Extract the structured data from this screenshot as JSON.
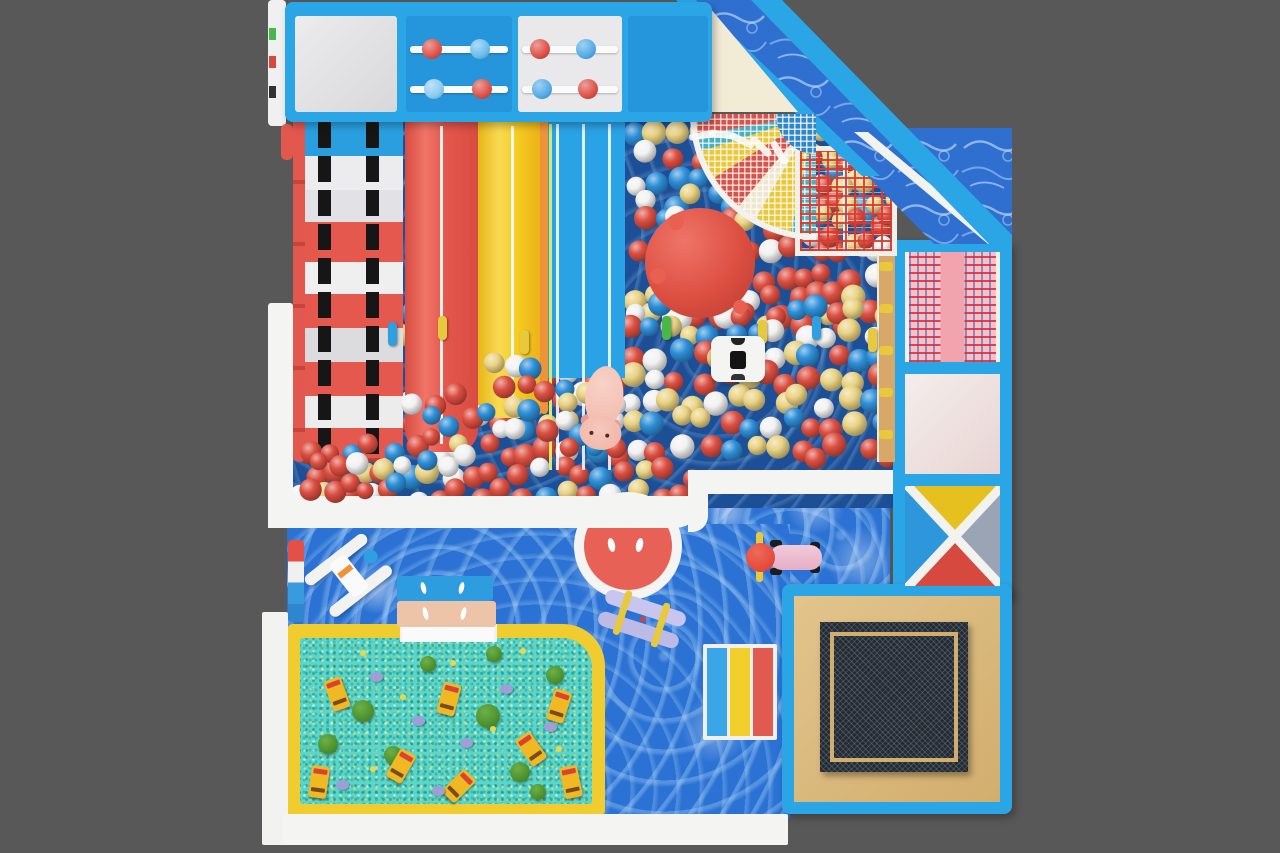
{
  "scene": {
    "name": "indoor-playground-top-view",
    "width": 1280,
    "height": 853,
    "background": "#585858"
  },
  "palette": {
    "bg": "#585858",
    "frame-blue": "#2aa6e6",
    "frame-blue-dark": "#1b86cc",
    "water-base": "#2b72d4",
    "pit-floor": "#1d4f96",
    "panel-gray": "#e2e2e4",
    "panel-white": "#eaeaec",
    "panel-blue": "#2596dc",
    "cream": "#f2ecd6",
    "slide-red": "#e4574c",
    "slide-red-light": "#f07568",
    "slide-yellow": "#f5c91e",
    "slide-orange": "#ef9338",
    "lane-blue": "#2aa2e6",
    "ladder-red": "#e2574e",
    "strap-black": "#161616",
    "white": "#f2f2f2",
    "meadow": "#5cd6c8",
    "meadow-border": "#f0cc2e",
    "tan": "#d9b87c",
    "tan-frame": "#d2ae6e",
    "wood": "#d8a868",
    "mesh-dark": "#232a32",
    "pink-panel": "#f4c2c8",
    "pink-stripe": "#f2a4ae",
    "x-yellow": "#e6c01e",
    "x-blue": "#2e96da",
    "x-gray": "#9aa4b4",
    "x-red": "#d6493e",
    "big-red-ball": "#dc4f41",
    "big-yellow-ball": "#ecc92c",
    "circle-red": "#e86156",
    "pig-pink": "#f4bfb2",
    "scooter-pink": "#eebcd0",
    "boat-lavender": "#c8c6ee",
    "bench-blue": "#2d9de0",
    "bench-tan": "#edc4a8",
    "peg-yellow": "#e8c83c",
    "peg-blue": "#2e9fe0",
    "peg-green": "#49b84a",
    "bus-yellow": "#f0b822",
    "bus-red": "#d84434",
    "tree-green": "#4a8f2a",
    "rock-lavender": "#9f9fd8",
    "flower-yellow": "#e8d84a",
    "mat-blue": "#3aa6e8",
    "mat-yellow": "#f2cf2a",
    "mat-red": "#e05a50"
  },
  "balls": {
    "colors": {
      "red": "#dc4f41",
      "blue": "#2e8fd8",
      "white": "#f2f2f2",
      "yellow": "#ead383"
    },
    "seed": 13,
    "regions": [
      {
        "name": "pit-top-right",
        "x": 628,
        "y": 124,
        "w": 262,
        "h": 118,
        "sp": 22,
        "r": 11,
        "layer": "low",
        "weights": {
          "blue": 0.3,
          "white": 0.2,
          "yellow": 0.2,
          "red": 0.3
        }
      },
      {
        "name": "pit-red-band",
        "x": 628,
        "y": 242,
        "w": 262,
        "h": 92,
        "sp": 22,
        "r": 11,
        "layer": "low",
        "weights": {
          "red": 0.55,
          "yellow": 0.18,
          "white": 0.15,
          "blue": 0.12
        }
      },
      {
        "name": "pit-mid-mix",
        "x": 296,
        "y": 300,
        "w": 592,
        "h": 68,
        "sp": 22,
        "r": 11,
        "layer": "low",
        "weights": {
          "blue": 0.33,
          "white": 0.25,
          "yellow": 0.17,
          "red": 0.25
        }
      },
      {
        "name": "pit-lower-mix",
        "x": 296,
        "y": 368,
        "w": 592,
        "h": 72,
        "sp": 22,
        "r": 11,
        "layer": "low",
        "weights": {
          "red": 0.38,
          "blue": 0.2,
          "white": 0.18,
          "yellow": 0.24
        }
      },
      {
        "name": "pit-bottom-red",
        "x": 296,
        "y": 440,
        "w": 400,
        "h": 62,
        "sp": 22,
        "r": 11,
        "layer": "low",
        "weights": {
          "red": 0.58,
          "white": 0.16,
          "yellow": 0.16,
          "blue": 0.1
        }
      },
      {
        "name": "pit-bottom-right",
        "x": 698,
        "y": 440,
        "w": 192,
        "h": 30,
        "sp": 22,
        "r": 11,
        "layer": "low",
        "weights": {
          "red": 0.5,
          "blue": 0.2,
          "white": 0.15,
          "yellow": 0.15
        }
      },
      {
        "name": "net-cells-balls",
        "x": 800,
        "y": 150,
        "w": 94,
        "h": 102,
        "sp": 20,
        "r": 10,
        "layer": "low",
        "weights": {
          "red": 0.45,
          "yellow": 0.25,
          "white": 0.2,
          "blue": 0.1
        }
      },
      {
        "name": "spill-red-slide",
        "x": 408,
        "y": 390,
        "w": 70,
        "h": 72,
        "sp": 20,
        "r": 10,
        "layer": "high",
        "weights": {
          "red": 0.45,
          "white": 0.2,
          "yellow": 0.2,
          "blue": 0.15
        }
      },
      {
        "name": "spill-yellow",
        "x": 480,
        "y": 354,
        "w": 66,
        "h": 94,
        "sp": 21,
        "r": 10,
        "layer": "high",
        "weights": {
          "red": 0.4,
          "yellow": 0.25,
          "white": 0.2,
          "blue": 0.15
        }
      },
      {
        "name": "spill-lane",
        "x": 550,
        "y": 376,
        "w": 72,
        "h": 92,
        "sp": 21,
        "r": 10,
        "layer": "high",
        "weights": {
          "blue": 0.3,
          "red": 0.3,
          "white": 0.2,
          "yellow": 0.2
        }
      },
      {
        "name": "spill-ladder",
        "x": 300,
        "y": 438,
        "w": 102,
        "h": 64,
        "sp": 20,
        "r": 10,
        "layer": "high",
        "weights": {
          "red": 0.5,
          "blue": 0.15,
          "white": 0.2,
          "yellow": 0.15
        }
      }
    ]
  },
  "abacus": {
    "panels": [
      {
        "x": 406,
        "y": 16,
        "w": 106,
        "h": 96,
        "bg": "#2596dc",
        "bars": [
          {
            "y": 30,
            "balls": [
              {
                "cx": 26,
                "color": "#dd5045"
              },
              {
                "cx": 74,
                "color": "#6cbcee"
              }
            ]
          },
          {
            "y": 70,
            "balls": [
              {
                "cx": 28,
                "color": "#8ccaf0"
              },
              {
                "cx": 76,
                "color": "#dd5045"
              }
            ]
          }
        ]
      },
      {
        "x": 518,
        "y": 16,
        "w": 104,
        "h": 96,
        "bg": "#e9e9eb",
        "bars": [
          {
            "y": 30,
            "balls": [
              {
                "cx": 22,
                "color": "#dd5045"
              },
              {
                "cx": 68,
                "color": "#52ace8"
              }
            ]
          },
          {
            "y": 70,
            "balls": [
              {
                "cx": 24,
                "color": "#52ace8"
              },
              {
                "cx": 70,
                "color": "#dd5045"
              }
            ]
          }
        ]
      }
    ]
  },
  "pegs": [
    {
      "x": 388,
      "y": 322,
      "color": "#2e9fe0"
    },
    {
      "x": 438,
      "y": 316,
      "color": "#e8c83c"
    },
    {
      "x": 520,
      "y": 330,
      "color": "#e8c83c"
    },
    {
      "x": 662,
      "y": 316,
      "color": "#49b84a"
    },
    {
      "x": 758,
      "y": 320,
      "color": "#e8c83c"
    },
    {
      "x": 812,
      "y": 316,
      "color": "#2e9fe0"
    },
    {
      "x": 868,
      "y": 328,
      "color": "#e8c83c"
    }
  ],
  "ladder_rungs": [
    262,
    304,
    346,
    388,
    430
  ],
  "fringe_angles": [
    -10,
    8,
    26,
    44,
    60
  ],
  "meadow": {
    "buses": [
      {
        "x": 28,
        "y": 40,
        "rot": -20
      },
      {
        "x": 140,
        "y": 45,
        "rot": 15
      },
      {
        "x": 92,
        "y": 112,
        "rot": 30
      },
      {
        "x": 222,
        "y": 95,
        "rot": -35
      },
      {
        "x": 10,
        "y": 128,
        "rot": 8
      },
      {
        "x": 150,
        "y": 132,
        "rot": 45
      },
      {
        "x": 250,
        "y": 52,
        "rot": 18
      },
      {
        "x": 262,
        "y": 128,
        "rot": -12
      }
    ],
    "trees": [
      {
        "x": 52,
        "y": 62,
        "r": 11
      },
      {
        "x": 84,
        "y": 108,
        "r": 9
      },
      {
        "x": 18,
        "y": 96,
        "r": 10
      },
      {
        "x": 120,
        "y": 18,
        "r": 8
      },
      {
        "x": 176,
        "y": 66,
        "r": 12
      },
      {
        "x": 210,
        "y": 124,
        "r": 10
      },
      {
        "x": 246,
        "y": 28,
        "r": 9
      },
      {
        "x": 186,
        "y": 8,
        "r": 8
      },
      {
        "x": 230,
        "y": 146,
        "r": 8
      }
    ],
    "rocks": [
      {
        "x": 70,
        "y": 34
      },
      {
        "x": 112,
        "y": 78
      },
      {
        "x": 160,
        "y": 100
      },
      {
        "x": 200,
        "y": 46
      },
      {
        "x": 36,
        "y": 142
      },
      {
        "x": 244,
        "y": 84
      },
      {
        "x": 132,
        "y": 148
      }
    ],
    "flowers": [
      {
        "x": 60,
        "y": 12
      },
      {
        "x": 100,
        "y": 56
      },
      {
        "x": 150,
        "y": 22
      },
      {
        "x": 190,
        "y": 88
      },
      {
        "x": 70,
        "y": 128
      },
      {
        "x": 220,
        "y": 10
      },
      {
        "x": 256,
        "y": 108
      }
    ]
  }
}
